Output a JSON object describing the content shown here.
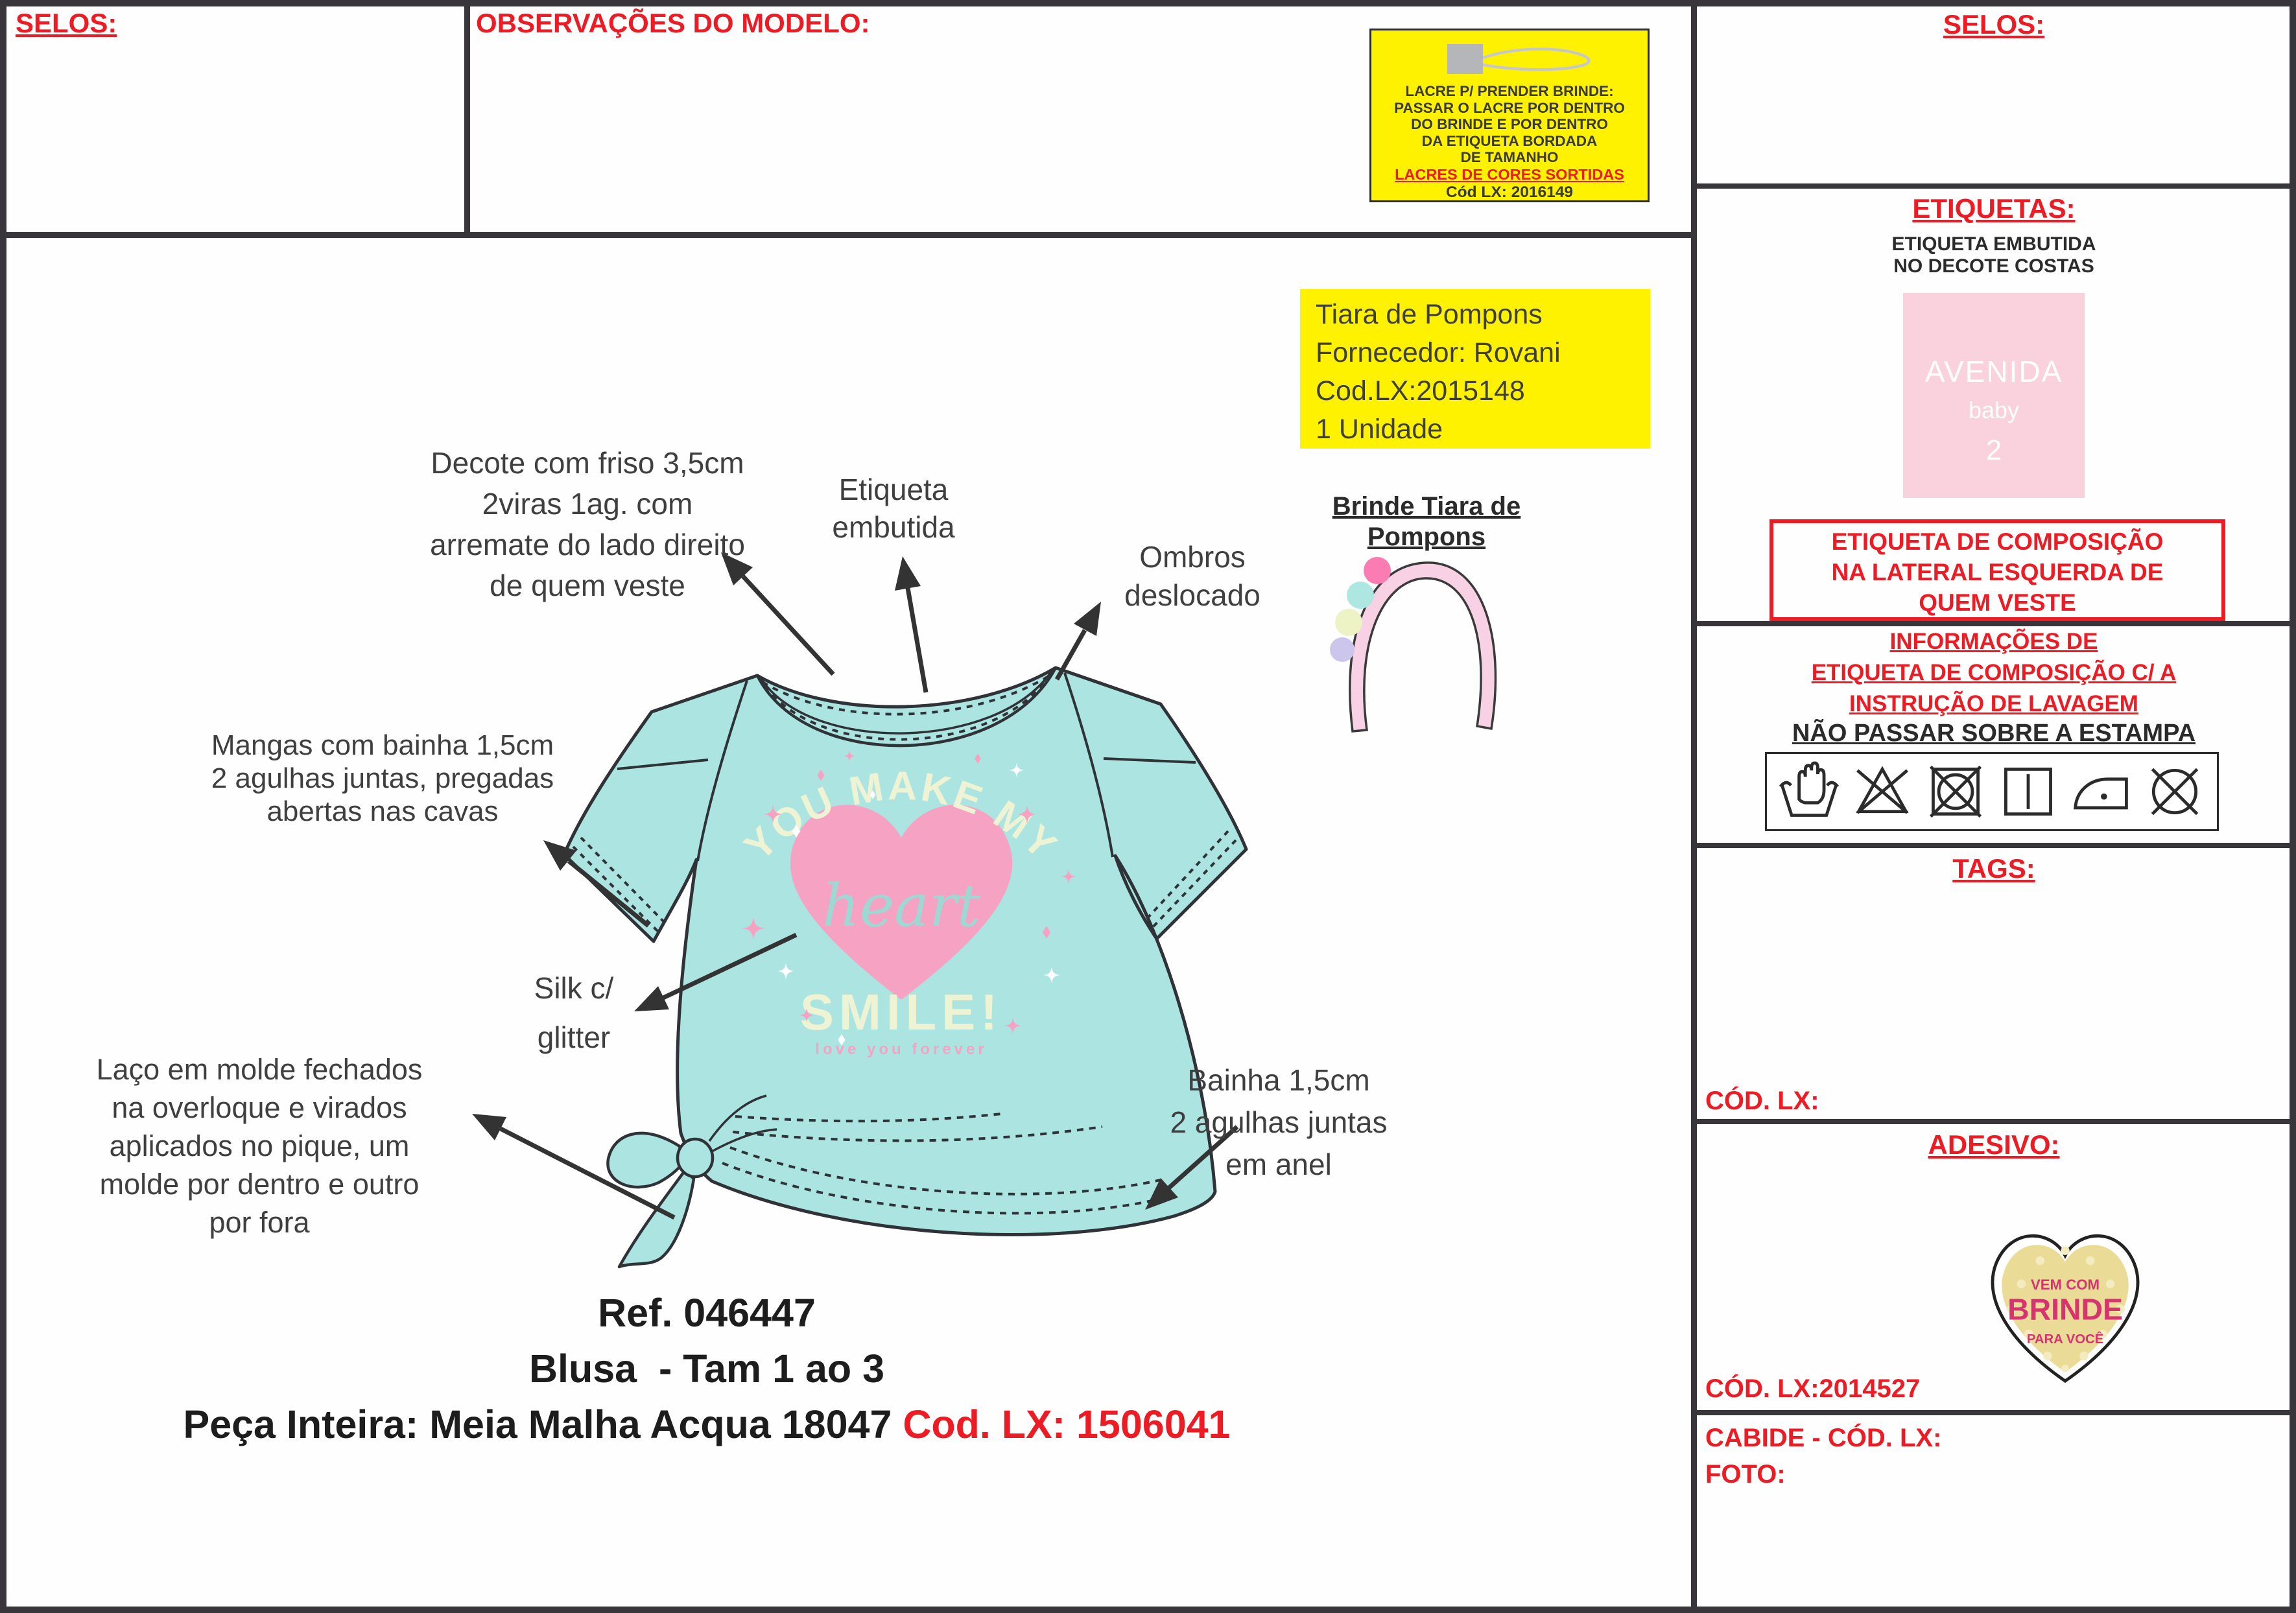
{
  "colors": {
    "red": "#ed1c24",
    "yellow": "#fff200",
    "aqua_shirt": "#ace4e2",
    "heart_pink": "#f6a3c3",
    "print_cream": "#eef3d3",
    "label_pink": "#f9d2de",
    "sticker_yellow": "#eadc96",
    "sticker_text": "#d6346f"
  },
  "top": {
    "selos": "SELOS:",
    "observacoes": "OBSERVAÇÕES DO MODELO:"
  },
  "lacre_box": {
    "icon": "lacre-loop-icon",
    "text": "LACRE P/ PRENDER BRINDE:\nPASSAR O LACRE POR DENTRO\nDO BRINDE E POR DENTRO\nDA ETIQUETA BORDADA\nDE TAMANHO",
    "highlight": "LACRES DE CORES SORTIDAS",
    "code": "Cód LX: 2016149"
  },
  "sidebar": {
    "selos_title": "SELOS:",
    "etiquetas_title": "ETIQUETAS:",
    "etiqueta_note": "ETIQUETA EMBUTIDA\nNO DECOTE COSTAS",
    "neck_label": {
      "brand": "AVENIDA",
      "sub": "baby",
      "size": "2"
    },
    "composition_note": "ETIQUETA DE COMPOSIÇÃO\nNA LATERAL ESQUERDA DE\nQUEM VESTE",
    "care_title": "INFORMAÇÕES DE\nETIQUETA DE COMPOSIÇÃO C/ A\nINSTRUÇÃO DE LAVAGEM",
    "care_note": "NÃO PASSAR SOBRE A ESTAMPA",
    "care_icons": [
      "hand-wash-icon",
      "do-not-bleach-icon",
      "do-not-tumble-dry-icon",
      "line-dry-icon",
      "iron-icon",
      "do-not-dry-clean-icon"
    ],
    "tags_title": "TAGS:",
    "tags_cod": "CÓD. LX:",
    "adesivo_title": "ADESIVO:",
    "sticker": {
      "line1": "VEM COM",
      "line2": "BRINDE",
      "line3": "PARA VOCÊ"
    },
    "adesivo_cod": "CÓD. LX:2014527",
    "cabide": "CABIDE - CÓD. LX:",
    "foto": "FOTO:"
  },
  "annotations": {
    "decote": "Decote com friso 3,5cm\n2viras 1ag. com\narremate do lado direito\nde quem veste",
    "etiqueta": "Etiqueta\nembutida",
    "ombros": "Ombros\ndeslocado",
    "mangas": "Mangas com bainha 1,5cm\n2 agulhas juntas, pregadas\nabertas nas cavas",
    "silk": "Silk c/\nglitter",
    "laco": "Laço em molde fechados\nna overloque e virados\naplicados no pique, um\nmolde por dentro e outro\npor fora",
    "bainha": "Bainha 1,5cm\n2 agulhas juntas\nem anel"
  },
  "brinde": {
    "title": "Brinde Tiara de\nPompons",
    "supplier": "Tiara de Pompons\nFornecedor: Rovani\nCod.LX:2015148\n1 Unidade"
  },
  "print": {
    "arc": "YOU MAKE MY",
    "heart_word": "heart",
    "smile": "SMILE!",
    "tagline": "love you forever"
  },
  "footer": {
    "ref": "Ref. 046447",
    "line2": "Blusa  - Tam 1 ao 3",
    "line3_black": "Peça Inteira: Meia Malha Acqua 18047 ",
    "line3_red": "Cod. LX: 1506041"
  }
}
